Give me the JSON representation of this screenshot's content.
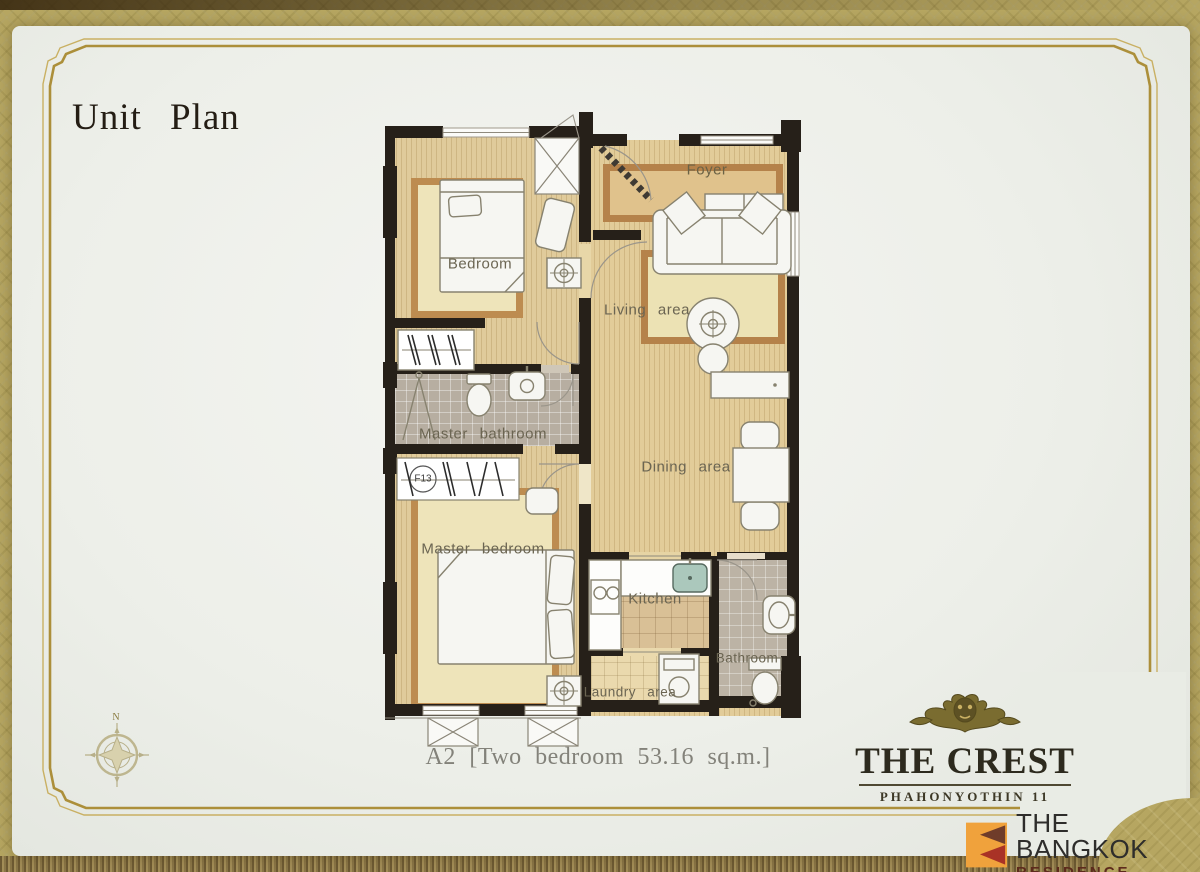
{
  "page": {
    "title": "Unit Plan",
    "caption": "A2 [Two bedroom 53.16 sq.m.]"
  },
  "plan": {
    "rooms": {
      "bedroom": "Bedroom",
      "foyer": "Foyer",
      "living": "Living area",
      "master_bathroom": "Master bathroom",
      "dining": "Dining area",
      "master_bedroom": "Master bedroom",
      "kitchen": "Kitchen",
      "bathroom": "Bathroom",
      "laundry": "Laundry area",
      "closet_tag": "F13"
    },
    "compass_north": "N"
  },
  "branding": {
    "crest": {
      "name": "THE CREST",
      "sub": "PHAHONYOTHIN 11"
    },
    "agency": {
      "line1": "THE BANGKOK",
      "line2": "RESIDENCE"
    }
  },
  "colors": {
    "pattern_gold": "#b6a661",
    "frame_gold": "#ac8f3a",
    "wall": "#262019",
    "floor_tan": "#e0cb9b",
    "rug_border": "#bd8c50",
    "agency_orange": "#f0a23c",
    "agency_maroon": "#a93226"
  }
}
